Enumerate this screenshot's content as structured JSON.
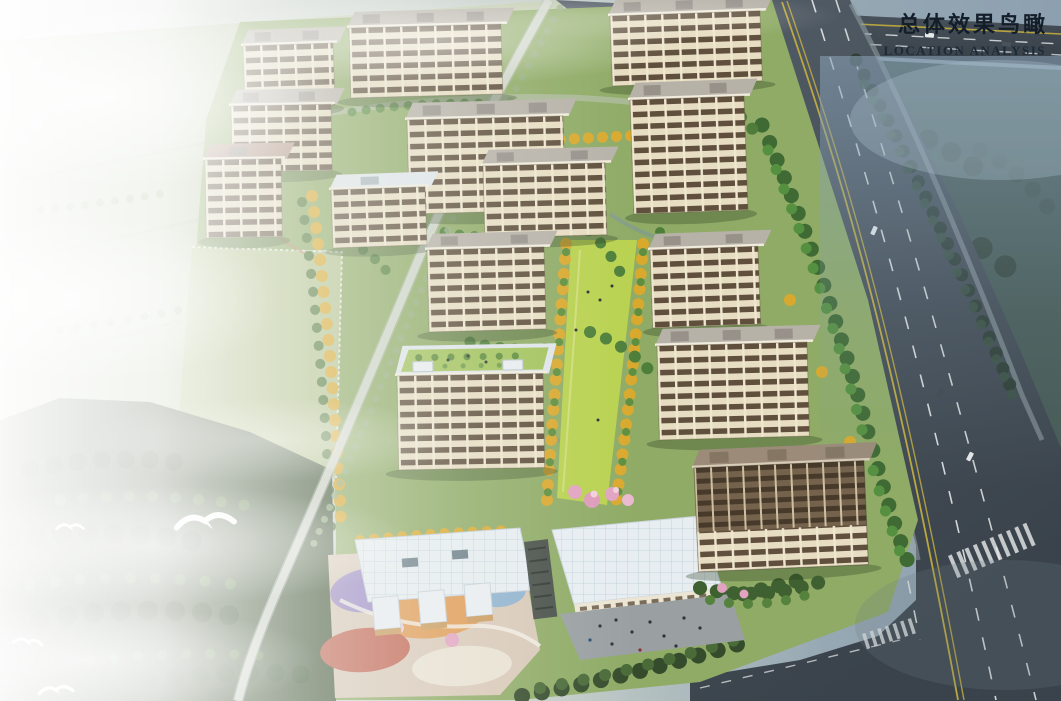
{
  "title_block": {
    "title_cn": "总体效果鸟瞰",
    "subtitle_en": "LOCATION ANALYSIS",
    "text_color": "#131e2a"
  },
  "scene": {
    "palette": {
      "sky_haze": "#8da0b0",
      "fog_white": "#f3f5f1",
      "field_green": "#c2cdb0",
      "forest_dark_left": "#46593c",
      "forest_dark_right": "#465a55",
      "mist_blue": "#87a0b4",
      "road_asphalt": "#434d55",
      "lane_yellow": "#c9b23e",
      "lane_white": "#f2f4f4",
      "estate_green": "#8fab66",
      "lawn_bright": "#b9d250",
      "tree_green": "#4e7f3a",
      "tree_yellow": "#d9a92e",
      "blossom_pink": "#e2a3c0",
      "facade_cream": "#e7ddc2",
      "window_band": "#604f3c",
      "roof_gray": "#b7b2a8",
      "roof_white": "#e7edf1",
      "playground_colors": [
        "#9b89c6",
        "#e09a52",
        "#c2624f",
        "#e9e2d2",
        "#8fb3cf"
      ],
      "bird_white": "#ffffff"
    }
  }
}
